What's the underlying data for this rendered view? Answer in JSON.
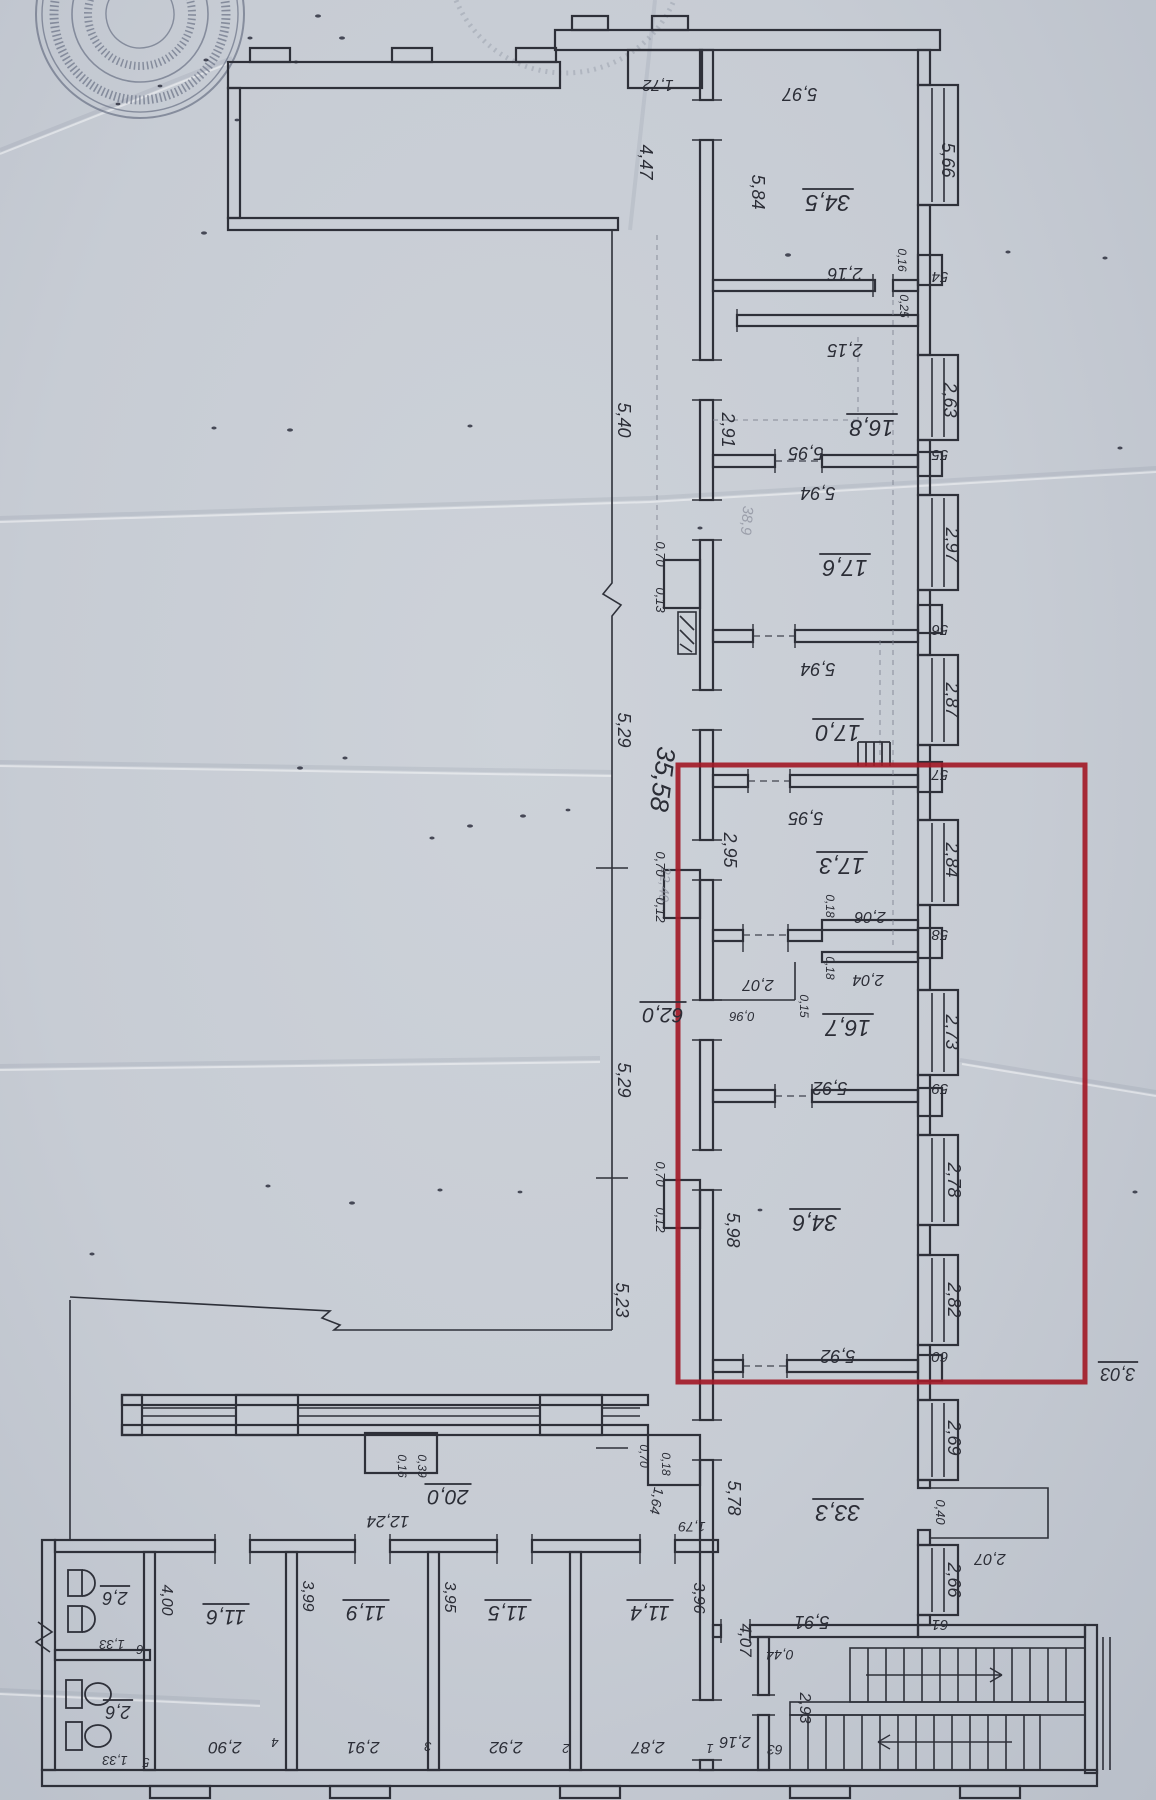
{
  "colors": {
    "paper": "#c7ccd4",
    "ink": "#2b2d36",
    "pencil": "#9094a0",
    "stamp_ink": "#5a6278",
    "highlight": "#a31b28"
  },
  "stamp": {
    "shape": "round-seal",
    "text_legible": false
  },
  "highlight_box": {
    "x": 678,
    "y": 765,
    "width": 407,
    "height": 617
  },
  "labels": {
    "areas": [
      {
        "t": "34,5",
        "x": 828,
        "y": 195,
        "r": 180,
        "s": 23,
        "u": true
      },
      {
        "t": "16,8",
        "x": 872,
        "y": 420,
        "r": 180,
        "s": 23,
        "u": true
      },
      {
        "t": "17,6",
        "x": 845,
        "y": 560,
        "r": 180,
        "s": 23,
        "u": true
      },
      {
        "t": "17,0",
        "x": 838,
        "y": 725,
        "r": 180,
        "s": 23,
        "u": true
      },
      {
        "t": "17,3",
        "x": 842,
        "y": 858,
        "r": 180,
        "s": 23,
        "u": true
      },
      {
        "t": "16,7",
        "x": 848,
        "y": 1020,
        "r": 180,
        "s": 23,
        "u": true
      },
      {
        "t": "34,6",
        "x": 815,
        "y": 1215,
        "r": 180,
        "s": 23,
        "u": true
      },
      {
        "t": "33,3",
        "x": 838,
        "y": 1505,
        "r": 180,
        "s": 23,
        "u": true
      },
      {
        "t": "62,0",
        "x": 663,
        "y": 1008,
        "r": 180,
        "s": 21,
        "u": true
      },
      {
        "t": "20,0",
        "x": 448,
        "y": 1490,
        "r": 180,
        "s": 21,
        "u": true
      },
      {
        "t": "2,6",
        "x": 115,
        "y": 1592,
        "r": 180,
        "s": 18,
        "u": true
      },
      {
        "t": "2,6",
        "x": 118,
        "y": 1706,
        "r": 180,
        "s": 18,
        "u": true
      },
      {
        "t": "11,6",
        "x": 226,
        "y": 1610,
        "r": 180,
        "s": 21,
        "u": true
      },
      {
        "t": "11,9",
        "x": 366,
        "y": 1606,
        "r": 180,
        "s": 21,
        "u": true
      },
      {
        "t": "11,5",
        "x": 508,
        "y": 1606,
        "r": 180,
        "s": 21,
        "u": true
      },
      {
        "t": "11,4",
        "x": 650,
        "y": 1606,
        "r": 180,
        "s": 21,
        "u": true
      },
      {
        "t": "3,03",
        "x": 1118,
        "y": 1368,
        "r": 180,
        "s": 18,
        "u": true
      }
    ],
    "dimensions": [
      {
        "t": "1,72",
        "x": 658,
        "y": 80,
        "r": 180,
        "s": 16
      },
      {
        "t": "5,97",
        "x": 800,
        "y": 88,
        "r": 180,
        "s": 18
      },
      {
        "t": "5,66",
        "x": 942,
        "y": 160,
        "r": 90,
        "s": 18
      },
      {
        "t": "4,47",
        "x": 640,
        "y": 162,
        "r": 90,
        "s": 18
      },
      {
        "t": "5,84",
        "x": 752,
        "y": 192,
        "r": 90,
        "s": 18
      },
      {
        "t": "2,16",
        "x": 845,
        "y": 268,
        "r": 180,
        "s": 18
      },
      {
        "t": "0,16",
        "x": 898,
        "y": 260,
        "r": 90,
        "s": 12
      },
      {
        "t": "0,25",
        "x": 900,
        "y": 306,
        "r": 90,
        "s": 12
      },
      {
        "t": "2,15",
        "x": 845,
        "y": 344,
        "r": 180,
        "s": 18
      },
      {
        "t": "2,91",
        "x": 722,
        "y": 430,
        "r": 90,
        "s": 18
      },
      {
        "t": "2,63",
        "x": 944,
        "y": 400,
        "r": 90,
        "s": 18
      },
      {
        "t": "5,95",
        "x": 806,
        "y": 447,
        "r": 180,
        "s": 18
      },
      {
        "t": "5,94",
        "x": 818,
        "y": 487,
        "r": 180,
        "s": 18
      },
      {
        "t": "2,97",
        "x": 946,
        "y": 545,
        "r": 90,
        "s": 18
      },
      {
        "t": "5,94",
        "x": 818,
        "y": 663,
        "r": 180,
        "s": 18
      },
      {
        "t": "2,87",
        "x": 946,
        "y": 700,
        "r": 90,
        "s": 18
      },
      {
        "t": "38,9",
        "x": 742,
        "y": 520,
        "r": 95,
        "s": 15,
        "f": true
      },
      {
        "t": "0,70",
        "x": 656,
        "y": 554,
        "r": 90,
        "s": 13
      },
      {
        "t": "0,13",
        "x": 656,
        "y": 600,
        "r": 90,
        "s": 13
      },
      {
        "t": "5,40",
        "x": 618,
        "y": 420,
        "r": 90,
        "s": 18
      },
      {
        "t": "5,29",
        "x": 618,
        "y": 730,
        "r": 90,
        "s": 18
      },
      {
        "t": "35,58",
        "x": 654,
        "y": 778,
        "r": 97,
        "s": 26
      },
      {
        "t": "22,40",
        "x": 660,
        "y": 884,
        "r": 94,
        "s": 14,
        "f": true
      },
      {
        "t": "0,70",
        "x": 656,
        "y": 864,
        "r": 90,
        "s": 13
      },
      {
        "t": "0,12",
        "x": 656,
        "y": 910,
        "r": 90,
        "s": 13
      },
      {
        "t": "5,29",
        "x": 618,
        "y": 1080,
        "r": 90,
        "s": 18
      },
      {
        "t": "0,70",
        "x": 656,
        "y": 1174,
        "r": 90,
        "s": 13
      },
      {
        "t": "0,12",
        "x": 656,
        "y": 1220,
        "r": 90,
        "s": 13
      },
      {
        "t": "5,23",
        "x": 616,
        "y": 1300,
        "r": 90,
        "s": 18
      },
      {
        "t": "5,95",
        "x": 806,
        "y": 812,
        "r": 180,
        "s": 18
      },
      {
        "t": "2,95",
        "x": 724,
        "y": 850,
        "r": 90,
        "s": 18
      },
      {
        "t": "2,84",
        "x": 946,
        "y": 860,
        "r": 90,
        "s": 18
      },
      {
        "t": "2,06",
        "x": 870,
        "y": 912,
        "r": 180,
        "s": 16
      },
      {
        "t": "0,18",
        "x": 826,
        "y": 906,
        "r": 90,
        "s": 12
      },
      {
        "t": "2,04",
        "x": 868,
        "y": 975,
        "r": 180,
        "s": 16
      },
      {
        "t": "0,18",
        "x": 826,
        "y": 968,
        "r": 90,
        "s": 12
      },
      {
        "t": "2,07",
        "x": 758,
        "y": 980,
        "r": 180,
        "s": 16
      },
      {
        "t": "0,96",
        "x": 742,
        "y": 1012,
        "r": 180,
        "s": 13
      },
      {
        "t": "0,15",
        "x": 800,
        "y": 1006,
        "r": 90,
        "s": 12
      },
      {
        "t": "5,92",
        "x": 830,
        "y": 1082,
        "r": 180,
        "s": 18
      },
      {
        "t": "2,73",
        "x": 946,
        "y": 1032,
        "r": 90,
        "s": 18
      },
      {
        "t": "5,98",
        "x": 727,
        "y": 1230,
        "r": 90,
        "s": 18
      },
      {
        "t": "2,78",
        "x": 948,
        "y": 1180,
        "r": 90,
        "s": 18
      },
      {
        "t": "2,82",
        "x": 948,
        "y": 1300,
        "r": 90,
        "s": 18
      },
      {
        "t": "5,92",
        "x": 838,
        "y": 1350,
        "r": 180,
        "s": 18
      },
      {
        "t": "5,78",
        "x": 728,
        "y": 1498,
        "r": 90,
        "s": 18
      },
      {
        "t": "2,69",
        "x": 948,
        "y": 1438,
        "r": 90,
        "s": 18
      },
      {
        "t": "0,40",
        "x": 936,
        "y": 1512,
        "r": 90,
        "s": 13
      },
      {
        "t": "2,07",
        "x": 990,
        "y": 1554,
        "r": 180,
        "s": 16
      },
      {
        "t": "2,66",
        "x": 948,
        "y": 1580,
        "r": 90,
        "s": 18
      },
      {
        "t": "5,91",
        "x": 812,
        "y": 1616,
        "r": 180,
        "s": 18
      },
      {
        "t": "0,44",
        "x": 780,
        "y": 1650,
        "r": 180,
        "s": 14
      },
      {
        "t": "2,93",
        "x": 800,
        "y": 1708,
        "r": 90,
        "s": 16
      },
      {
        "t": "2,16",
        "x": 735,
        "y": 1737,
        "r": 180,
        "s": 16
      },
      {
        "t": "4,07",
        "x": 740,
        "y": 1640,
        "r": 90,
        "s": 17
      },
      {
        "t": "3,96",
        "x": 694,
        "y": 1598,
        "r": 90,
        "s": 16
      },
      {
        "t": "2,87",
        "x": 648,
        "y": 1742,
        "r": 180,
        "s": 17
      },
      {
        "t": "3,95",
        "x": 445,
        "y": 1597,
        "r": 90,
        "s": 16
      },
      {
        "t": "2,92",
        "x": 506,
        "y": 1742,
        "r": 180,
        "s": 17
      },
      {
        "t": "3,99",
        "x": 303,
        "y": 1596,
        "r": 90,
        "s": 16
      },
      {
        "t": "2,91",
        "x": 363,
        "y": 1742,
        "r": 180,
        "s": 17
      },
      {
        "t": "4,00",
        "x": 162,
        "y": 1600,
        "r": 90,
        "s": 16
      },
      {
        "t": "2,90",
        "x": 225,
        "y": 1742,
        "r": 180,
        "s": 17
      },
      {
        "t": "1,33",
        "x": 112,
        "y": 1640,
        "r": 180,
        "s": 13
      },
      {
        "t": "1,33",
        "x": 115,
        "y": 1756,
        "r": 180,
        "s": 13
      },
      {
        "t": "12,24",
        "x": 388,
        "y": 1516,
        "r": 180,
        "s": 17
      },
      {
        "t": "0,39",
        "x": 418,
        "y": 1466,
        "r": 90,
        "s": 12
      },
      {
        "t": "0,16",
        "x": 398,
        "y": 1466,
        "r": 90,
        "s": 12
      },
      {
        "t": "0,70",
        "x": 640,
        "y": 1456,
        "r": 90,
        "s": 12
      },
      {
        "t": "0,18",
        "x": 662,
        "y": 1464,
        "r": 90,
        "s": 12
      },
      {
        "t": "1,64",
        "x": 652,
        "y": 1500,
        "r": 100,
        "s": 14
      },
      {
        "t": "1,79",
        "x": 692,
        "y": 1522,
        "r": 180,
        "s": 14
      }
    ],
    "numbers": [
      {
        "t": "54",
        "x": 940,
        "y": 272,
        "r": 180,
        "s": 15
      },
      {
        "t": "55",
        "x": 940,
        "y": 450,
        "r": 180,
        "s": 15
      },
      {
        "t": "56",
        "x": 940,
        "y": 625,
        "r": 180,
        "s": 15
      },
      {
        "t": "57",
        "x": 940,
        "y": 770,
        "r": 180,
        "s": 15
      },
      {
        "t": "58",
        "x": 940,
        "y": 930,
        "r": 180,
        "s": 15
      },
      {
        "t": "59",
        "x": 940,
        "y": 1084,
        "r": 180,
        "s": 15
      },
      {
        "t": "60",
        "x": 940,
        "y": 1352,
        "r": 180,
        "s": 15
      },
      {
        "t": "61",
        "x": 940,
        "y": 1620,
        "r": 180,
        "s": 15
      },
      {
        "t": "63",
        "x": 775,
        "y": 1745,
        "r": 180,
        "s": 14
      },
      {
        "t": "6",
        "x": 140,
        "y": 1645,
        "r": 180,
        "s": 13
      },
      {
        "t": "5",
        "x": 146,
        "y": 1758,
        "r": 180,
        "s": 13
      },
      {
        "t": "4",
        "x": 275,
        "y": 1738,
        "r": 180,
        "s": 13
      },
      {
        "t": "3",
        "x": 428,
        "y": 1742,
        "r": 180,
        "s": 13
      },
      {
        "t": "2",
        "x": 566,
        "y": 1744,
        "r": 180,
        "s": 13
      },
      {
        "t": "1",
        "x": 710,
        "y": 1744,
        "r": 180,
        "s": 13
      }
    ]
  }
}
